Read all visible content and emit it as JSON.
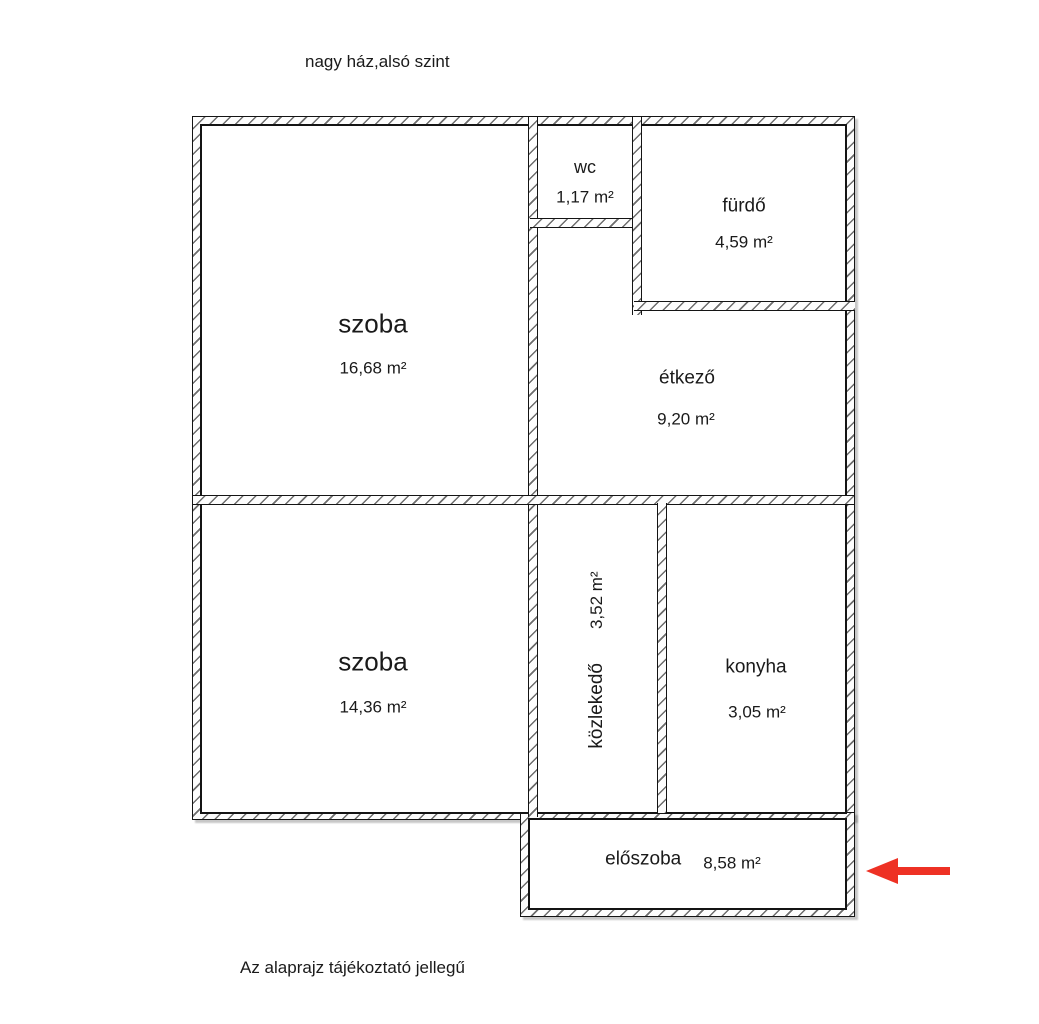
{
  "page": {
    "title": "nagy ház,alsó szint",
    "footer_note": "Az alaprajz tájékoztató jellegű"
  },
  "rooms": {
    "szoba_felso": {
      "name": "szoba",
      "area": "16,68 m²"
    },
    "wc": {
      "name": "wc",
      "area": "1,17 m²"
    },
    "furdo": {
      "name": "fürdő",
      "area": "4,59 m²"
    },
    "etkezo": {
      "name": "étkező",
      "area": "9,20 m²"
    },
    "szoba_also": {
      "name": "szoba",
      "area": "14,36 m²"
    },
    "kozlekedo": {
      "name": "közlekedő",
      "area": "3,52 m²"
    },
    "konyha": {
      "name": "konyha",
      "area": "3,05 m²"
    },
    "eloszoba": {
      "name": "előszoba",
      "area": "8,58 m²"
    }
  },
  "entrance_arrow": {
    "direction": "left",
    "color": "#ee3124"
  }
}
